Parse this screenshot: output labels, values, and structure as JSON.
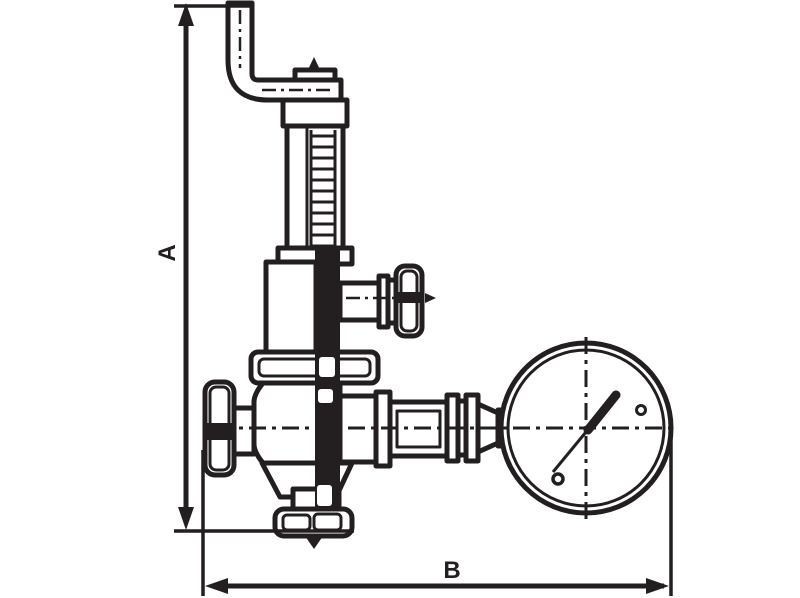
{
  "diagram": {
    "background": "#ffffff",
    "ink": "#231f20",
    "dimension_labels": {
      "height": "A",
      "width": "B"
    },
    "components": [
      "vent-elbow-pipe",
      "adjusting-screw-bonnet",
      "spring-chamber",
      "side-knob",
      "diaphragm-flange",
      "valve-body",
      "inlet-handwheel",
      "outlet-union-fittings",
      "pressure-gauge",
      "bottom-outlet-flange",
      "height-dimension",
      "width-dimension"
    ]
  }
}
